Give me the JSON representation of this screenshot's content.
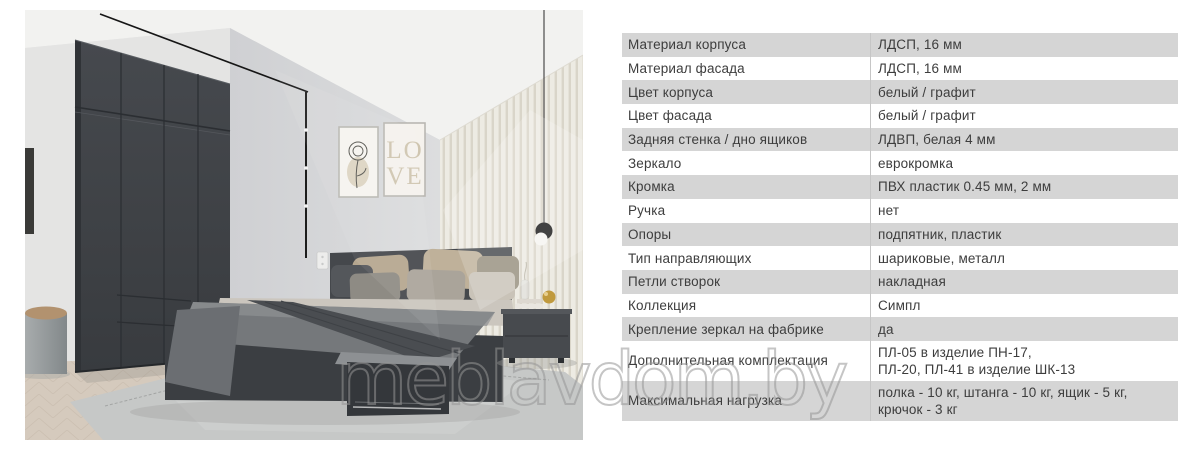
{
  "watermark": {
    "text": "meblavdom.by"
  },
  "photo": {
    "description": "bedroom with graphite wardrobe, bed with drawers and nightstand",
    "posters": {
      "love_line1": "LO",
      "love_line2": "VE"
    }
  },
  "specs": {
    "colors": {
      "row_alt": "#d5d5d5",
      "text": "#3d3d3d",
      "divider": "#c6c6c6"
    },
    "rows": [
      {
        "label": "Материал корпуса",
        "value": "ЛДСП, 16 мм"
      },
      {
        "label": "Материал фасада",
        "value": "ЛДСП, 16 мм"
      },
      {
        "label": "Цвет корпуса",
        "value": "белый / графит"
      },
      {
        "label": "Цвет фасада",
        "value": "белый / графит"
      },
      {
        "label": "Задняя стенка / дно ящиков",
        "value": "ЛДВП, белая 4 мм"
      },
      {
        "label": "Зеркало",
        "value": "еврокромка"
      },
      {
        "label": "Кромка",
        "value": "ПВХ пластик 0.45 мм, 2 мм"
      },
      {
        "label": "Ручка",
        "value": "нет"
      },
      {
        "label": "Опоры",
        "value": "подпятник, пластик"
      },
      {
        "label": "Тип направляющих",
        "value": "шариковые, металл"
      },
      {
        "label": "Петли створок",
        "value": "накладная"
      },
      {
        "label": "Коллекция",
        "value": "Симпл"
      },
      {
        "label": "Крепление зеркал на фабрике",
        "value": "да"
      },
      {
        "label": "Дополнительная комплектация",
        "value": "ПЛ-05 в изделие ПН-17,\nПЛ-20, ПЛ-41 в изделие ШК-13"
      },
      {
        "label": "Максимальная нагрузка",
        "value": "полка - 10 кг, штанга - 10 кг, ящик - 5 кг,\nкрючок - 3 кг"
      }
    ]
  }
}
